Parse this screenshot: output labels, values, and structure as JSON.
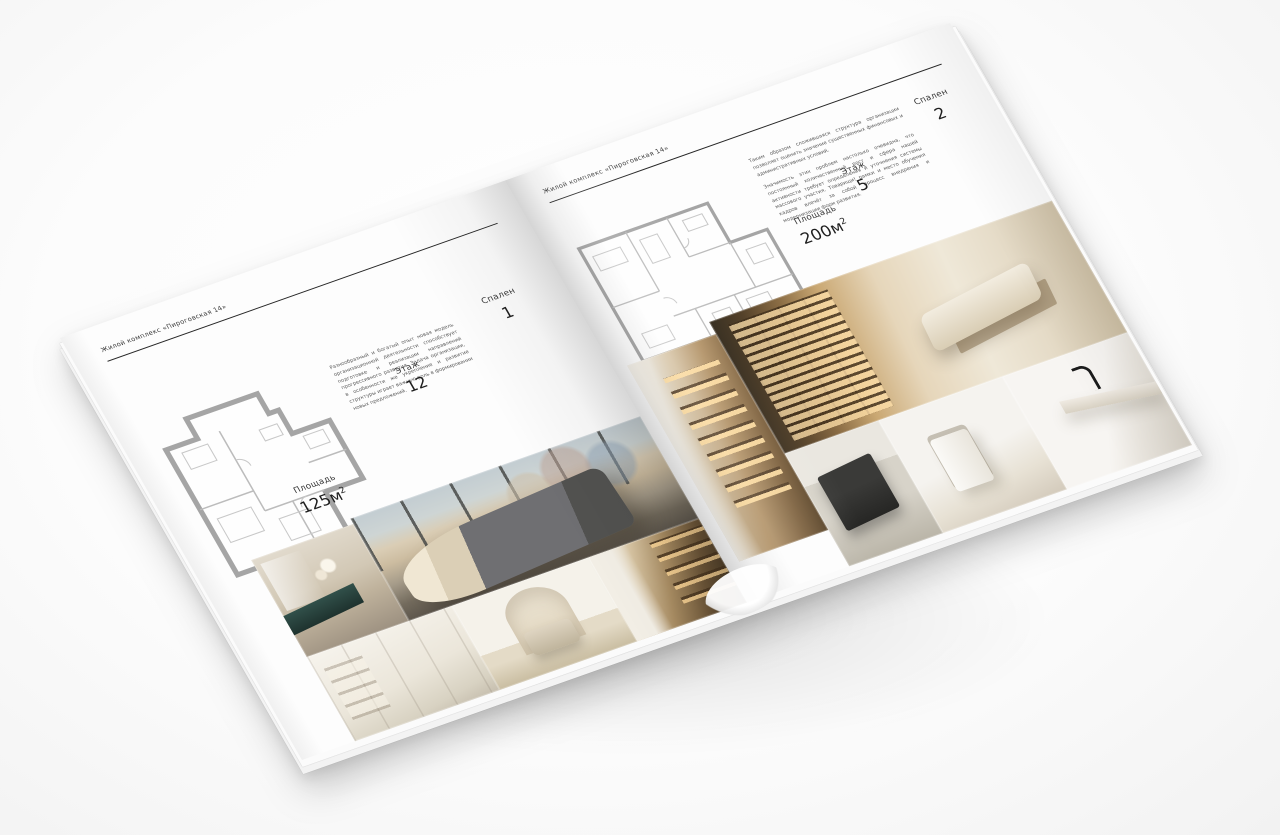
{
  "project_name": "Жилой комплекс «Пироговская 14»",
  "page_left": {
    "header": "Жилой комплекс «Пироговская 14»",
    "description": "Разнообразный и богатый опыт новая модель организационной деятельности способствует подготовке и реализации направлений прогрессивного развития. Задача организации, в особенности же укрепление и развитие структуры играет важную роль в формировании новых предложений.",
    "specs": {
      "area_label": "Площадь",
      "area_value": "125м",
      "area_sup": "2",
      "floor_label": "Этаж",
      "floor_value": "12",
      "bedrooms_label": "Спален",
      "bedrooms_value": "1"
    }
  },
  "page_right": {
    "header": "Жилой комплекс «Пироговская 14»",
    "description_1": "Таким образом сложившаяся структура организации позволяет оценить значение существенных финансовых и административных условий.",
    "description_2": "Значимость этих проблем настолько очевидна, что постоянный количественный рост и сфера нашей активности требует определения и уточнения системы массового участия. Товарищи! рамки и место обучения кадров влечёт за собой процесс внедрения и модернизации форм развития.",
    "specs": {
      "area_label": "Площадь",
      "area_value": "200м",
      "area_sup": "2",
      "floor_label": "Этаж",
      "floor_value": "5",
      "bedrooms_label": "Спален",
      "bedrooms_value": "2"
    }
  }
}
